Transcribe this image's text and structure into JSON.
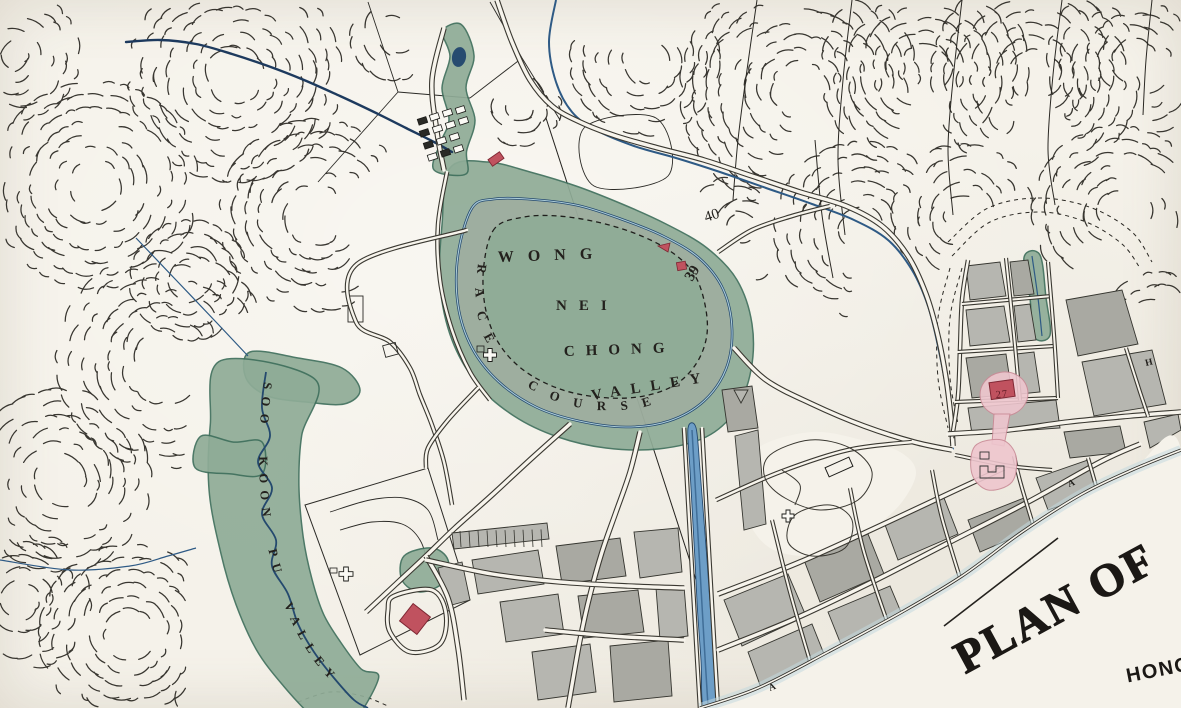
{
  "map_type": "hand-coloured historical survey map",
  "labels": {
    "wong": "WONG",
    "nei": "NEI",
    "chong": "CHONG",
    "valley": "VALLEY",
    "race_course": "RACE COURSE",
    "soo_koon_pu_valley": "SOO KOON PU VALLEY",
    "lot_40": "40",
    "lot_39": "39",
    "lot_27": "27",
    "block_a_praya": "A",
    "block_a_shore": "A",
    "block_h": "H"
  },
  "title_block": {
    "title": "PLAN OF",
    "subtitle_partial": "HONG"
  },
  "colors": {
    "paper": "#f5f2ea",
    "ink": "#211f1b",
    "hachure": "#23211c",
    "valley_green": "#8fac97",
    "green_edge": "#3f6f5c",
    "water_dark": "#24496e",
    "water_mid": "#2e5a85",
    "water_light": "#aacbd8",
    "canal_fill": "#6d9ec7",
    "track_gray": "#a6aca1",
    "block_gray": "#b6b6b0",
    "block_gray_dark": "#a9a9a2",
    "street_paper": "#f7f4ec",
    "casing": "#3a3831",
    "red_building": "#c0525f",
    "red_dark": "#7e2733",
    "pink": "#eec6ce",
    "pink_edge": "#c98a96",
    "sea_wash": "#c2d9de",
    "title_ink": "#1b1815"
  }
}
